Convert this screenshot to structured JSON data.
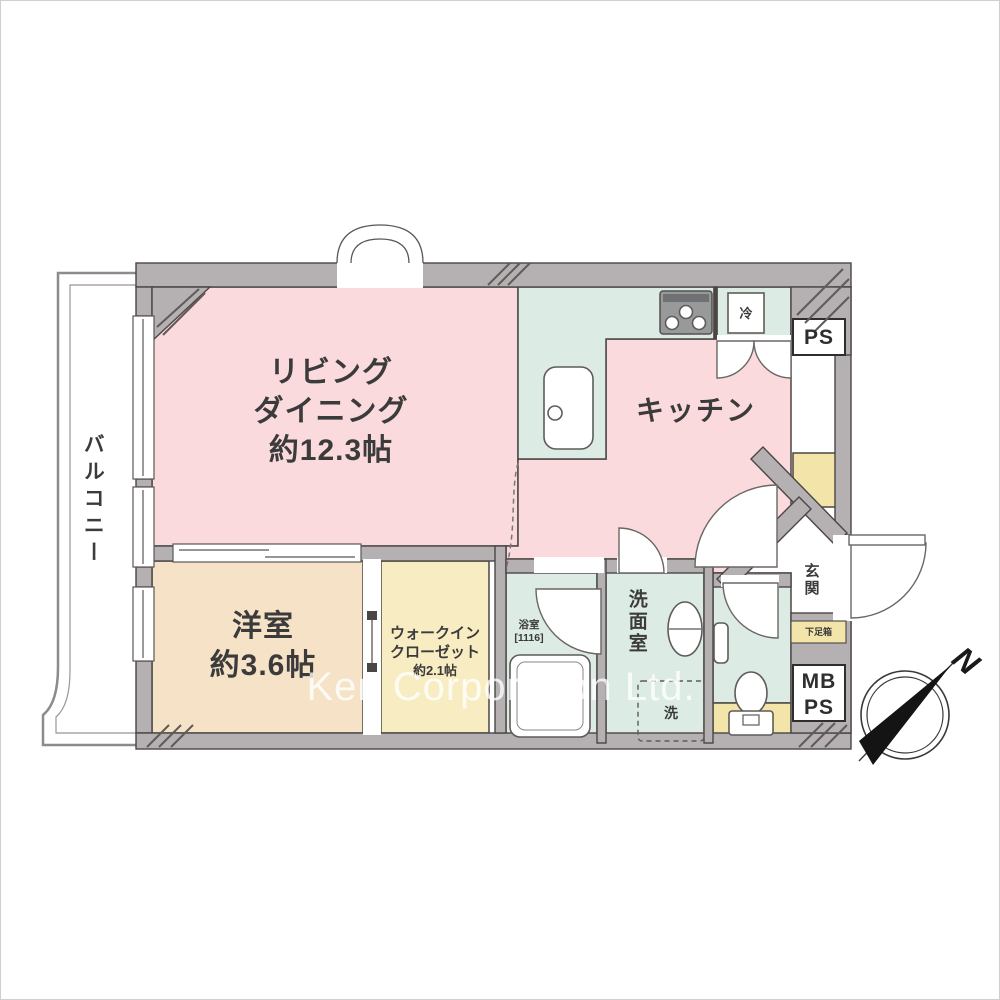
{
  "watermark": "Ken Corporation Ltd.",
  "compass": {
    "north": "N"
  },
  "colors": {
    "wall": "#b5b0b2",
    "room_pink": "#fadadd",
    "room_mint": "#dcebe3",
    "room_cream": "#f6e2c6",
    "room_yellow": "#f8ecc2",
    "accent_yellow": "#f3e4a9",
    "line": "#4a4644"
  },
  "rooms": {
    "living_dining": {
      "line1": "リビング",
      "line2": "ダイニング",
      "size": "約12.3帖"
    },
    "kitchen": {
      "label": "キッチン"
    },
    "western_room": {
      "label": "洋室",
      "size": "約3.6帖"
    },
    "walk_in_closet": {
      "line1": "ウォークイン",
      "line2": "クローゼット",
      "size": "約2.1帖"
    },
    "balcony": {
      "label": "バルコニー"
    },
    "bathroom": {
      "label": "浴室",
      "size": "[1116]"
    },
    "washroom": {
      "label": "洗面室"
    },
    "entrance": {
      "label": "玄関"
    },
    "shoe_cabinet": {
      "label": "下足箱"
    }
  },
  "service": {
    "ps": "PS",
    "mb": "MB",
    "mb_ps": "PS"
  },
  "fixtures": {
    "refrigerator": "冷",
    "washer": "洗"
  }
}
